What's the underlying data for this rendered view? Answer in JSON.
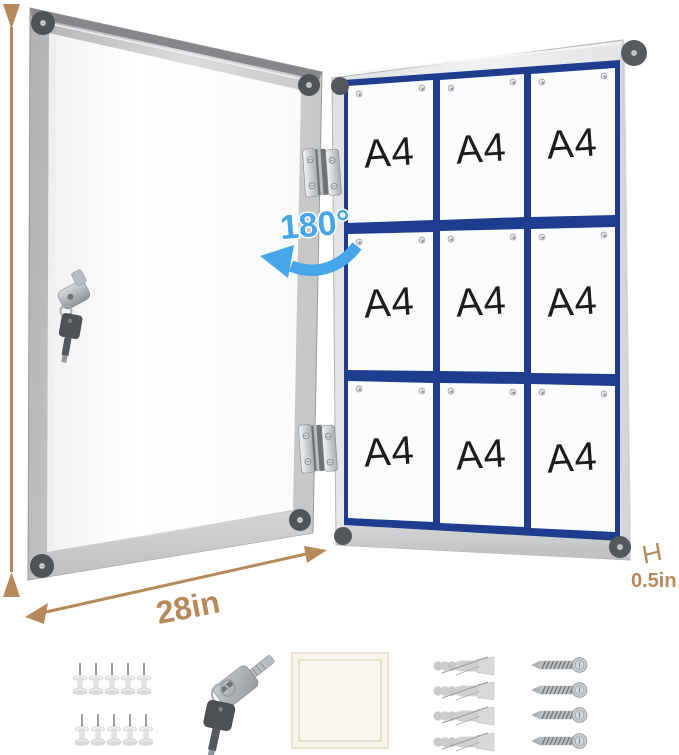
{
  "annotations": {
    "height": "38in",
    "width": "28in",
    "depth": "0.5in",
    "swing": "180°"
  },
  "board": {
    "grid": {
      "rows": 3,
      "cols": 3
    },
    "papers": [
      "A4",
      "A4",
      "A4",
      "A4",
      "A4",
      "A4",
      "A4",
      "A4",
      "A4"
    ]
  },
  "accessories": {
    "push_pins": {
      "icon": "push-pin-icon",
      "count": 10
    },
    "keys": {
      "icon": "key-icon",
      "count": 2
    },
    "adhesive_pad": {
      "icon": "adhesive-pad-icon",
      "count": 1
    },
    "wall_anchors": {
      "icon": "wall-anchor-icon",
      "count": 4
    },
    "screws": {
      "icon": "screw-icon",
      "count": 4
    }
  },
  "colors": {
    "dimension_text": "#b5895a",
    "rotation_text": "#47a5e9",
    "board_panel_blue": "#1e3d8f",
    "frame_aluminum": "#d9dadb",
    "paper_white": "#fbfcfe",
    "corner_cap": "#4f5357"
  }
}
